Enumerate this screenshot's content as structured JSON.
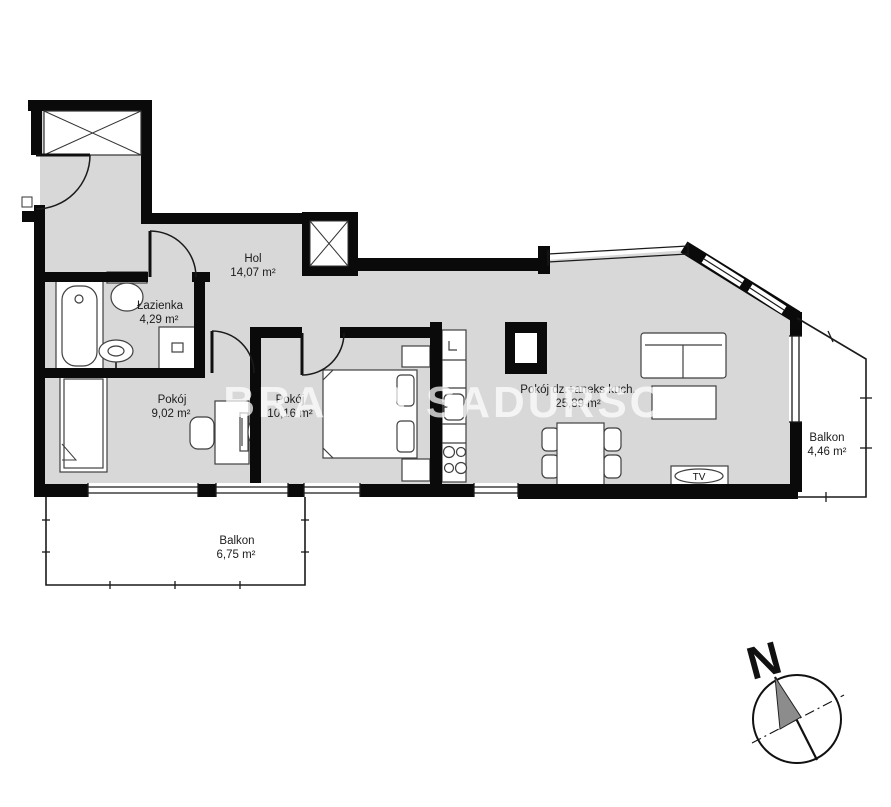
{
  "watermark": "BRACIA SADURSCY",
  "compass": {
    "north": "N"
  },
  "rooms": {
    "hol": {
      "name": "Hol",
      "area": "14,07 m²"
    },
    "lazienka": {
      "name": "Łazienka",
      "area": "4,29 m²"
    },
    "pokoj_left": {
      "name": "Pokój",
      "area": "9,02 m²"
    },
    "pokoj_middle": {
      "name": "Pokój",
      "area": "10,16 m²"
    },
    "pokoj_living": {
      "name": "Pokój dz.+aneks kuch.",
      "area": "25,89 m²"
    },
    "balkon_right": {
      "name": "Balkon",
      "area": "4,46 m²"
    },
    "balkon_bottom": {
      "name": "Balkon",
      "area": "6,75 m²"
    }
  },
  "furniture": {
    "tv_label": "TV"
  },
  "colors": {
    "floor": "#d8d8d8",
    "wall": "#0a0a0a",
    "furniture_outline": "#3f3f3f",
    "watermark": "rgba(255,255,255,0.72)"
  }
}
